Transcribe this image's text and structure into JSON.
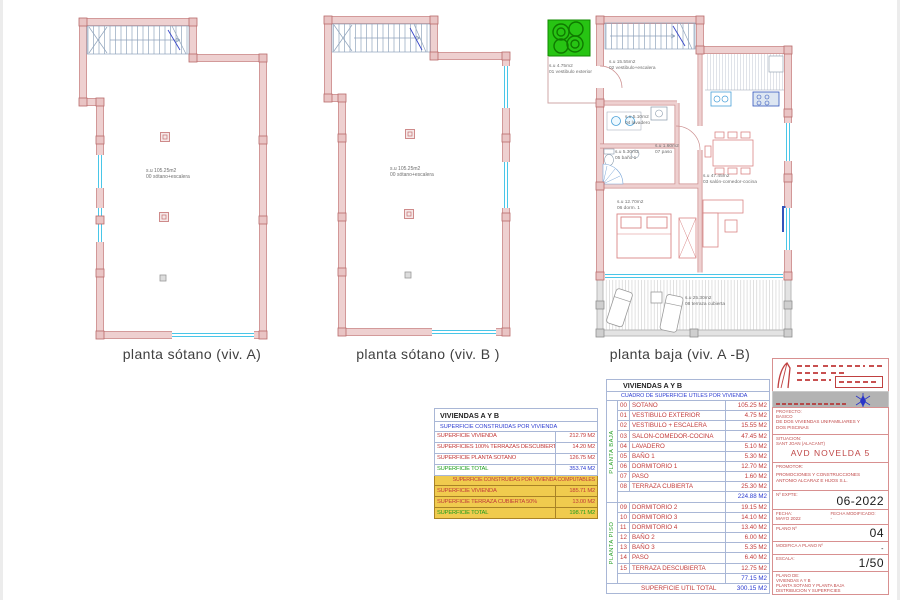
{
  "plans": [
    {
      "title": "planta sótano (viv. A)",
      "area": "s.u 105.25m2",
      "room": "00 sótano+escalera"
    },
    {
      "title": "planta sótano (viv. B )",
      "area": "s.u 105.25m2",
      "room": "00 sótano+escalera"
    },
    {
      "title": "planta baja (viv. A -B)",
      "rooms": [
        {
          "area": "s.u 4.75m2",
          "name": "01 vestibulo exterior"
        },
        {
          "area": "s.u 15.55m2",
          "name": "02 vestibulo+escalera"
        },
        {
          "area": "s.u 5.10m2",
          "name": "04 lavadero"
        },
        {
          "area": "s.u 5.30m2",
          "name": "05 baño 1"
        },
        {
          "area": "s.u 1.60m2",
          "name": "07 paso"
        },
        {
          "area": "s.u 47.45m2",
          "name": "03 salón-comedor-cocina"
        },
        {
          "area": "s.u 12.70m2",
          "name": "06 dorm. 1"
        },
        {
          "area": "s.u 25.30m2",
          "name": "08 terraza cubierta"
        }
      ]
    }
  ],
  "left_table": {
    "title": "VIVIENDAS A Y B",
    "subtitle": "SUPERFICIE CONSTRUIDAS POR VIVIENDA",
    "rows": [
      {
        "c": [
          "SUPERFICIE VIVIENDA",
          "212.79 M2"
        ],
        "t": "citem"
      },
      {
        "c": [
          "SUPERFICIES 100% TERRAZAS DESCUBIERTAS",
          "14.20 M2"
        ],
        "t": "citem"
      },
      {
        "c": [
          "SUPERFICIE PLANTA SOTANO",
          "126.75 M2"
        ],
        "t": "citem"
      },
      {
        "c": [
          "SUPERFICIE TOTAL",
          "353.74 M2"
        ],
        "t": "ctotal"
      },
      {
        "c": [
          "SUPERFICIE CONSTRUIDAS POR VIVIENDA COMPUTABLES"
        ],
        "t": "yhead",
        "s": [
          2
        ]
      },
      {
        "c": [
          "SUPERFICIE VIVIENDA",
          "185.71 M2"
        ],
        "t": "yitem"
      },
      {
        "c": [
          "SUPERFICIE TERRAZA CUBIERTA 50%",
          "13.00 M2"
        ],
        "t": "yitem"
      },
      {
        "c": [
          "SUPERFICIE TOTAL",
          "198.71 M2"
        ],
        "t": "ytotal"
      }
    ]
  },
  "main_table": {
    "title": "VIVIENDAS A Y B",
    "subtitle": "CUADRO DE SUPERFICIE UTILES POR VIVIENDA",
    "group1": "PLANTA BAJA",
    "group2": "PLANTA PISO",
    "rows": [
      {
        "c": [
          "00",
          "SOTANO",
          "105.25 M2"
        ],
        "t": "item"
      },
      {
        "c": [
          "01",
          "VESTIBULO EXTERIOR",
          "4.75 M2"
        ],
        "t": "item"
      },
      {
        "c": [
          "02",
          "VESTIBULO + ESCALERA",
          "15.55 M2"
        ],
        "t": "item"
      },
      {
        "c": [
          "03",
          "SALON-COMEDOR-COCINA",
          "47.45 M2"
        ],
        "t": "item"
      },
      {
        "c": [
          "04",
          "LAVADERO",
          "5.10 M2"
        ],
        "t": "item"
      },
      {
        "c": [
          "05",
          "BAÑO 1",
          "5.30 M2"
        ],
        "t": "item"
      },
      {
        "c": [
          "06",
          "DORMITORIO 1",
          "12.70 M2"
        ],
        "t": "item"
      },
      {
        "c": [
          "07",
          "PASO",
          "1.60 M2"
        ],
        "t": "item"
      },
      {
        "c": [
          "08",
          "TERRAZA CUBIERTA",
          "25.30 M2"
        ],
        "t": "item"
      },
      {
        "c": [
          "",
          "224.88 M2"
        ],
        "t": "sub",
        "s": [
          2,
          1
        ]
      },
      {
        "c": [
          "09",
          "DORMITORIO 2",
          "19.15 M2"
        ],
        "t": "item"
      },
      {
        "c": [
          "10",
          "DORMITORIO 3",
          "14.10 M2"
        ],
        "t": "item"
      },
      {
        "c": [
          "11",
          "DORMITORIO 4",
          "13.40 M2"
        ],
        "t": "item"
      },
      {
        "c": [
          "12",
          "BAÑO 2",
          "6.00 M2"
        ],
        "t": "item"
      },
      {
        "c": [
          "13",
          "BAÑO 3",
          "5.35 M2"
        ],
        "t": "item"
      },
      {
        "c": [
          "14",
          "PASO",
          "6.40 M2"
        ],
        "t": "item"
      },
      {
        "c": [
          "15",
          "TERRAZA DESCUBIERTA",
          "12.75 M2"
        ],
        "t": "item"
      },
      {
        "c": [
          "",
          "77.15 M2"
        ],
        "t": "sub",
        "s": [
          2,
          1
        ]
      }
    ],
    "total_label": "SUPERFICIE UTIL TOTAL",
    "total_value": "300.15 M2"
  },
  "title_block": {
    "project_label": "PROYECTO:",
    "project_type": "BASICO",
    "project_desc1": "DE DOS VIVIENDAS UNIFAMILIARES Y",
    "project_desc2": "DOS PISCINAS",
    "location_label": "SITUACION:",
    "location_small": "SANT JOAN (ALACANT)",
    "location_main": "AVD NOVELDA 5",
    "developer_label": "PROMOTOR:",
    "developer_line1": "PROMOCIONES Y CONSTRUCCIONES",
    "developer_line2": "ANTONIO ALCARAZ E HIJOS S.L.",
    "expte_label": "Nº EXPTE:",
    "expte_value": "06-2022",
    "date_label": "FECHA:",
    "date_value": "MAYO 2022",
    "date_mod_label": "FECHA MODIFICADO:",
    "date_mod_value": "-",
    "plan_no_label": "PLANO Nº",
    "plan_no_value": "04",
    "modifies_label": "MODIFICA A PLANO Nº",
    "modifies_value": "-",
    "scale_label": "ESCALA:",
    "scale_value": "1/50",
    "sheet_label": "PLANO DE:",
    "sheet_line1": "VIVIENDAS A Y B",
    "sheet_line2": "PLANTA SOTANO Y PLANTA BAJA",
    "sheet_line3": "DISTRIBUCION Y SUPERFICIES"
  },
  "colors": {
    "text_red": "#c23b3b",
    "text_blue": "#2b3bd0",
    "text_green": "#1f9e1f",
    "highlight_yellow": "#f0cb4e",
    "wall_pink": "#eed0d0",
    "wall_edge": "#cf9292",
    "window_cyan": "#49c6e8",
    "vegetation_green": "#27c413"
  }
}
